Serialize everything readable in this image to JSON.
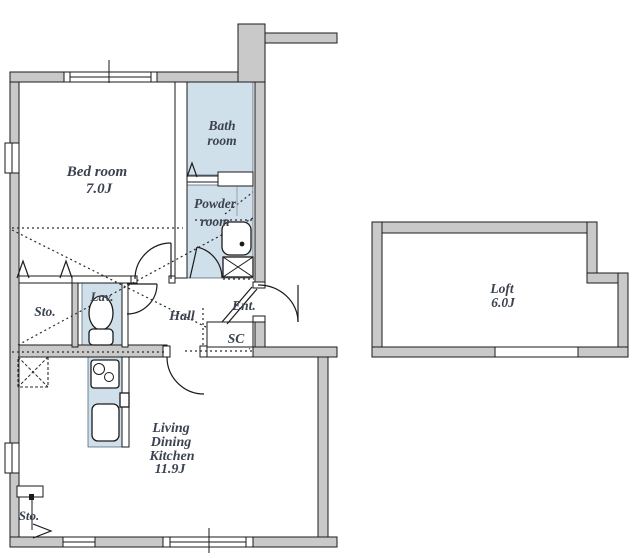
{
  "palette": {
    "wall_fill": "#c9c9c9",
    "room_fill": "#cfe0eb",
    "line_color": "#1a1a1a",
    "label_color": "#3b4250",
    "background": "#ffffff"
  },
  "rooms": {
    "bedroom": {
      "name": "Bed room",
      "size": "7.0J"
    },
    "bathroom": {
      "line1": "Bath",
      "line2": "room"
    },
    "powder_room": {
      "line1": "Powder",
      "line2": "room"
    },
    "lavatory": {
      "label": "Lav."
    },
    "storage_mid": {
      "label": "Sto."
    },
    "hall": {
      "label": "Hall"
    },
    "entrance": {
      "label": "Ent."
    },
    "shoe_closet": {
      "label": "SC"
    },
    "ldk": {
      "lines": [
        "Living",
        "Dining",
        "Kitchen",
        "11.9J"
      ]
    },
    "loft": {
      "name": "Loft",
      "size": "6.0J"
    },
    "storage_bottom": {
      "label": "Sto."
    }
  }
}
